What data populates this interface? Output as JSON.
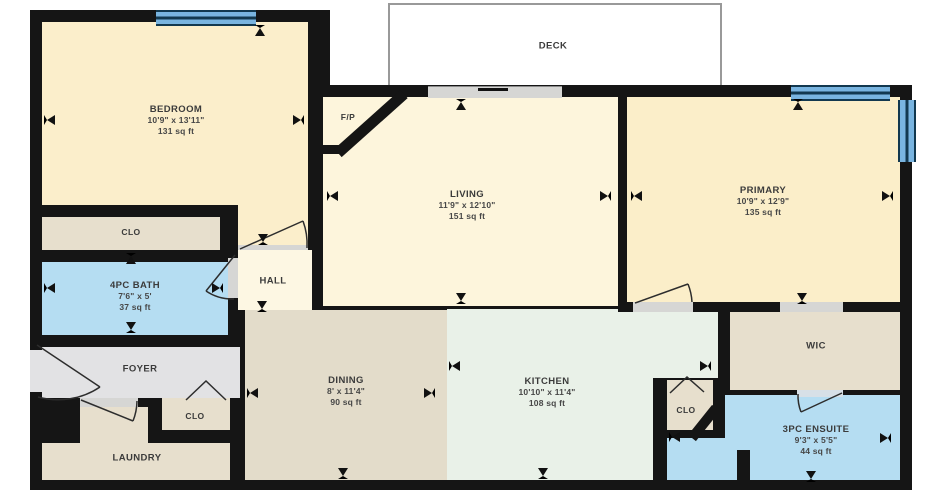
{
  "floorplan": {
    "title": "Apartment floor plan",
    "rooms": {
      "bedroom": {
        "name": "BEDROOM",
        "dims": "10'9\" x 13'11\"",
        "area": "131 sq ft"
      },
      "living": {
        "name": "LIVING",
        "dims": "11'9\" x 12'10\"",
        "area": "151 sq ft"
      },
      "primary": {
        "name": "PRIMARY",
        "dims": "10'9\" x 12'9\"",
        "area": "135 sq ft"
      },
      "bath": {
        "name": "4PC BATH",
        "dims": "7'6\" x 5'",
        "area": "37 sq ft"
      },
      "dining": {
        "name": "DINING",
        "dims": "8' x 11'4\"",
        "area": "90 sq ft"
      },
      "kitchen": {
        "name": "KITCHEN",
        "dims": "10'10\" x 11'4\"",
        "area": "108 sq ft"
      },
      "ensuite": {
        "name": "3PC ENSUITE",
        "dims": "9'3\" x 5'5\"",
        "area": "44 sq ft"
      },
      "deck": {
        "name": "DECK"
      },
      "hall": {
        "name": "HALL"
      },
      "foyer": {
        "name": "FOYER"
      },
      "laundry": {
        "name": "LAUNDRY"
      },
      "wic": {
        "name": "WIC"
      },
      "fireplace": {
        "name": "F/P"
      },
      "closet_bedroom": {
        "name": "CLO"
      },
      "closet_foyer": {
        "name": "CLO"
      },
      "closet_kitchen": {
        "name": "CLO"
      }
    },
    "colors": {
      "wall": "#151515",
      "bedroom_floor": "#fbeecb",
      "living_floor": "#fdf5dc",
      "primary_floor": "#fbeec9",
      "closet_floor": "#e7dfcd",
      "dining_floor": "#e3dcca",
      "bath_floor": "#b5ddf2",
      "kitchen_floor": "#e9f1e8",
      "foyer_floor": "#e2e2e4",
      "window": "#79b4e0",
      "deck_border": "#999999"
    }
  }
}
